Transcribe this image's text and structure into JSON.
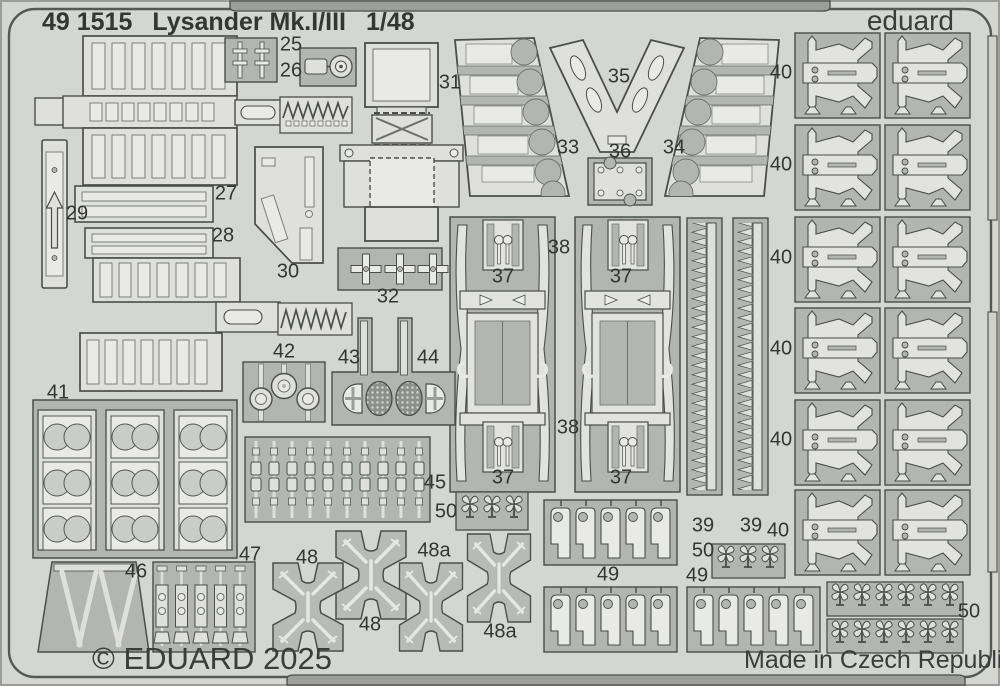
{
  "sheet": {
    "product_code": "49 1515",
    "product_title": "Lysander Mk.I/III",
    "product_scale": "1/48",
    "brand": "eduard",
    "copyright": "© EDUARD 2025",
    "origin": "Made in Czech Republic",
    "colors": {
      "sheet_bg": "#d4d6d2",
      "carrier": "#b2b5b0",
      "part": "#dfe0dd",
      "etch_light": "#e9eae7",
      "outline": "#4b4e4a",
      "text": "#333632"
    }
  },
  "part_labels": [
    {
      "t": "25",
      "x": 291,
      "y": 45
    },
    {
      "t": "26",
      "x": 291,
      "y": 71
    },
    {
      "t": "27",
      "x": 226,
      "y": 194
    },
    {
      "t": "28",
      "x": 223,
      "y": 236
    },
    {
      "t": "29",
      "x": 77,
      "y": 214
    },
    {
      "t": "30",
      "x": 288,
      "y": 272
    },
    {
      "t": "31",
      "x": 450,
      "y": 83
    },
    {
      "t": "32",
      "x": 388,
      "y": 297
    },
    {
      "t": "33",
      "x": 568,
      "y": 148
    },
    {
      "t": "34",
      "x": 674,
      "y": 148
    },
    {
      "t": "35",
      "x": 619,
      "y": 77
    },
    {
      "t": "36",
      "x": 620,
      "y": 152
    },
    {
      "t": "37",
      "x": 503,
      "y": 277
    },
    {
      "t": "37",
      "x": 621,
      "y": 277
    },
    {
      "t": "37",
      "x": 503,
      "y": 478
    },
    {
      "t": "37",
      "x": 621,
      "y": 478
    },
    {
      "t": "38",
      "x": 559,
      "y": 248
    },
    {
      "t": "38",
      "x": 568,
      "y": 428
    },
    {
      "t": "39",
      "x": 703,
      "y": 526
    },
    {
      "t": "39",
      "x": 751,
      "y": 526
    },
    {
      "t": "40",
      "x": 781,
      "y": 73
    },
    {
      "t": "40",
      "x": 781,
      "y": 165
    },
    {
      "t": "40",
      "x": 781,
      "y": 258
    },
    {
      "t": "40",
      "x": 781,
      "y": 349
    },
    {
      "t": "40",
      "x": 781,
      "y": 440
    },
    {
      "t": "40",
      "x": 778,
      "y": 531
    },
    {
      "t": "41",
      "x": 58,
      "y": 393
    },
    {
      "t": "42",
      "x": 284,
      "y": 352
    },
    {
      "t": "43",
      "x": 349,
      "y": 358
    },
    {
      "t": "44",
      "x": 428,
      "y": 358
    },
    {
      "t": "45",
      "x": 435,
      "y": 483
    },
    {
      "t": "46",
      "x": 136,
      "y": 572
    },
    {
      "t": "47",
      "x": 250,
      "y": 555
    },
    {
      "t": "48",
      "x": 307,
      "y": 558
    },
    {
      "t": "48",
      "x": 370,
      "y": 625
    },
    {
      "t": "48a",
      "x": 434,
      "y": 551
    },
    {
      "t": "48a",
      "x": 500,
      "y": 632
    },
    {
      "t": "49",
      "x": 608,
      "y": 575
    },
    {
      "t": "49",
      "x": 697,
      "y": 576
    },
    {
      "t": "50",
      "x": 446,
      "y": 512
    },
    {
      "t": "50",
      "x": 703,
      "y": 551
    },
    {
      "t": "50",
      "x": 969,
      "y": 612
    }
  ]
}
